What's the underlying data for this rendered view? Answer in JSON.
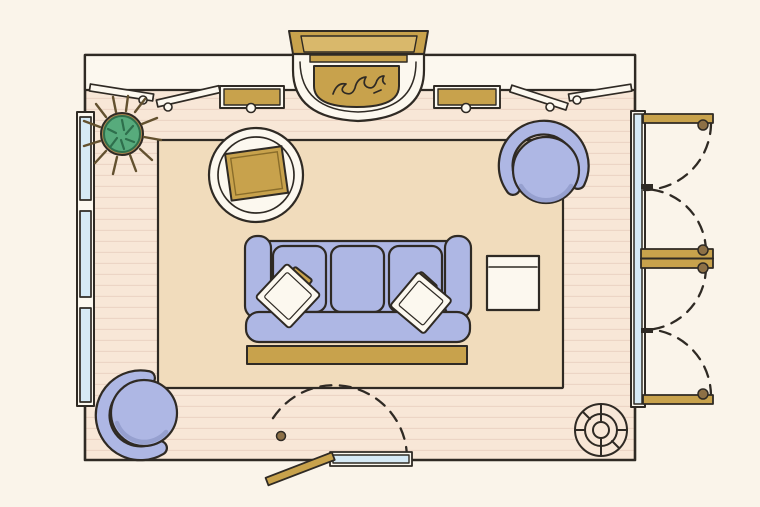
{
  "scene": {
    "label": "Top-down illustrated floor plan of a living room",
    "view": "plan",
    "room": "living room"
  },
  "colors": {
    "background": "#faf4ea",
    "wall": "#fcf8ef",
    "outline": "#2f2a24",
    "floor": "#f8e7d7",
    "floorLine": "#ecd5c5",
    "rug": "#f1dcbc",
    "upholstery": "#aeb7e4",
    "upholsteryShade": "#96a0cf",
    "gold": "#c8a24c",
    "goldLight": "#d9b86b",
    "goldDark": "#8a6d2a",
    "glass": "#d6eaf6",
    "plantGreen": "#57ab7c",
    "plantDark": "#2e6f4c",
    "spike": "#63512f",
    "pot": "#a8854f",
    "knob": "#8d7046"
  },
  "elements": [
    {
      "name": "wood-floor",
      "description": "plank flooring filling the room"
    },
    {
      "name": "area-rug",
      "description": "large beige rectangular rug"
    },
    {
      "name": "top-wall-console",
      "description": "built-in console band along top wall"
    },
    {
      "name": "fireplace",
      "description": "fireplace with gold mantel, curved hearth and flames"
    },
    {
      "name": "console-drawer-left",
      "description": "open gold drawer, left console"
    },
    {
      "name": "console-drawer-right",
      "description": "open gold drawer, right console"
    },
    {
      "name": "cabinet-doors-open",
      "description": "four open cabinet door leaves with knobs"
    },
    {
      "name": "windows-left",
      "description": "three windows on the left wall"
    },
    {
      "name": "french-doors-right",
      "description": "two pairs of outswing french doors with swing arcs"
    },
    {
      "name": "entry-door-bottom",
      "description": "single door with swing arc, bottom wall"
    },
    {
      "name": "potted-plant",
      "description": "spiky potted plant, top-left corner"
    },
    {
      "name": "round-side-table",
      "description": "round table with square gold tray"
    },
    {
      "name": "armchair-top-right",
      "description": "round barrel chair"
    },
    {
      "name": "armchair-bottom-left",
      "description": "round barrel chair"
    },
    {
      "name": "sofa",
      "description": "three-cushion sofa with two throw pillows"
    },
    {
      "name": "throw-pillows",
      "description": "white pillows with gold accent pillows"
    },
    {
      "name": "coffee-bench",
      "description": "gold bench in front of sofa"
    },
    {
      "name": "square-side-table",
      "description": "white side table right of sofa"
    },
    {
      "name": "ceiling-fixture-symbol",
      "description": "round fixture symbol, bottom-right corner"
    }
  ]
}
